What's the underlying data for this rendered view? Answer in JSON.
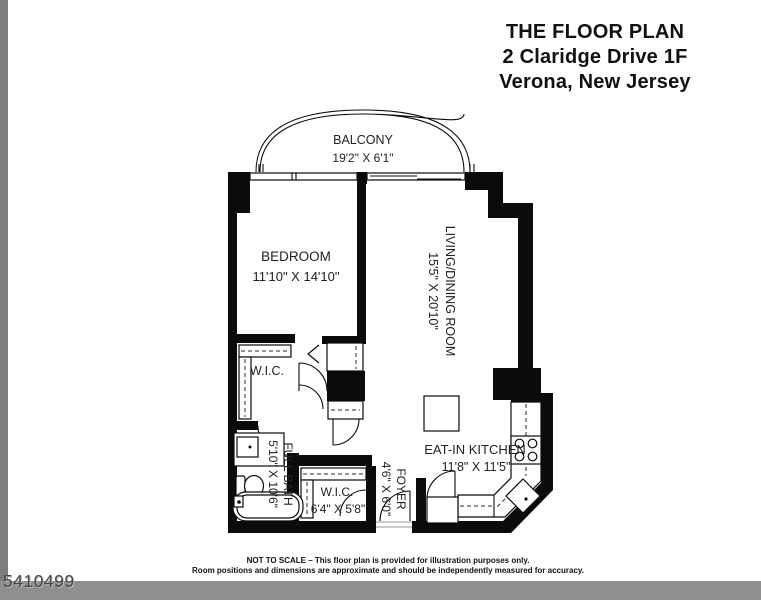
{
  "title": {
    "line1": "THE FLOOR PLAN",
    "line2": "2 Claridge Drive 1F",
    "line3": "Verona, New Jersey"
  },
  "rooms": {
    "balcony": {
      "name": "BALCONY",
      "dims": "19'2\" X 6'1\""
    },
    "bedroom": {
      "name": "BEDROOM",
      "dims": "11'10\" X 14'10\""
    },
    "living": {
      "name": "LIVING/DINING ROOM",
      "dims": "15'5\" X 20'10\""
    },
    "wic_upper": {
      "name": "W.I.C."
    },
    "full_bath": {
      "name": "FULL BATH",
      "dims": "5'10\" X 10'6\""
    },
    "wic_lower": {
      "name": "W.I.C.",
      "dims": "6'4\" X 5'8\""
    },
    "foyer": {
      "name": "FOYER",
      "dims": "4'6\" X 6'0\""
    },
    "kitchen": {
      "name": "EAT-IN KITCHEN",
      "dims": "11'8\" X 11'5\""
    }
  },
  "footer": {
    "line1": "NOT TO SCALE – This floor plan is provided for illustration purposes only.",
    "line2": "Room positions and dimensions are approximate and should be independently measured for accuracy."
  },
  "watermark": "5410499",
  "colors": {
    "wall": "#0b0b0b",
    "background": "#ffffff",
    "left_strip": "#7d7d7d",
    "bottom_strip": "#8f8f8f",
    "watermark_text": "#474747"
  }
}
